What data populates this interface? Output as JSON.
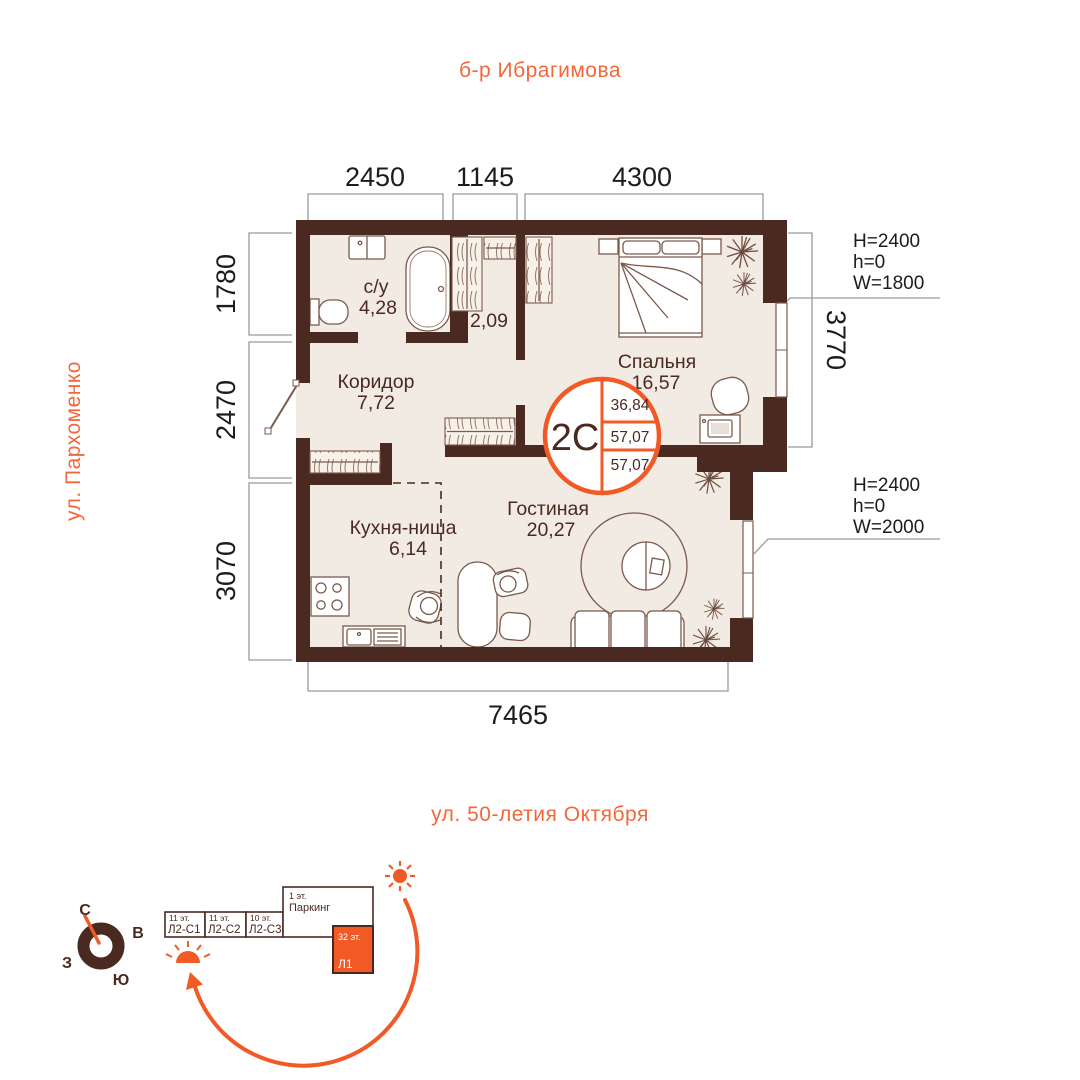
{
  "plan": {
    "streets": {
      "top": "б-р Ибрагимова",
      "left": "ул. Пархоменко",
      "bottom": "ул. 50-летия Октября"
    },
    "dims": {
      "top1": "2450",
      "top2": "1145",
      "top3": "4300",
      "left1": "1780",
      "left2": "2470",
      "left3": "3070",
      "right1": "3770",
      "bottom1": "7465"
    },
    "win1": {
      "l1": "H=2400",
      "l2": "h=0",
      "l3": "W=1800"
    },
    "win2": {
      "l1": "H=2400",
      "l2": "h=0",
      "l3": "W=2000"
    },
    "rooms": {
      "bathroom_name": "с/у",
      "bathroom_area": "4,28",
      "closet_area": "2,09",
      "corridor_name": "Коридор",
      "corridor_area": "7,72",
      "bedroom_name": "Спальня",
      "bedroom_area": "16,57",
      "kitchen_name": "Кухня-ниша",
      "kitchen_area": "6,14",
      "living_name": "Гостиная",
      "living_area": "20,27"
    },
    "badge": {
      "type": "2С",
      "v1": "36,84",
      "v2": "57,07",
      "v3": "57,07"
    }
  },
  "site": {
    "compass": {
      "n": "С",
      "e": "В",
      "s": "Ю",
      "w": "З"
    },
    "b1_floors": "11 эт.",
    "b1_name": "Л2-С1",
    "b2_floors": "11 эт.",
    "b2_name": "Л2-С2",
    "b3_floors": "10 эт.",
    "b3_name": "Л2-С3",
    "parking_floors": "1 эт.",
    "parking_name": "Паркинг",
    "tower_floors": "32 эт.",
    "tower_name": "Л1"
  },
  "colors": {
    "accent": "#f15a24",
    "street_text": "#f2683a",
    "wall": "#4a2a20",
    "floor": "#f2ebe3",
    "dim_text": "#1c1c1c",
    "dim_line": "#9a9a9a",
    "furniture_line": "#7a5a4c"
  }
}
